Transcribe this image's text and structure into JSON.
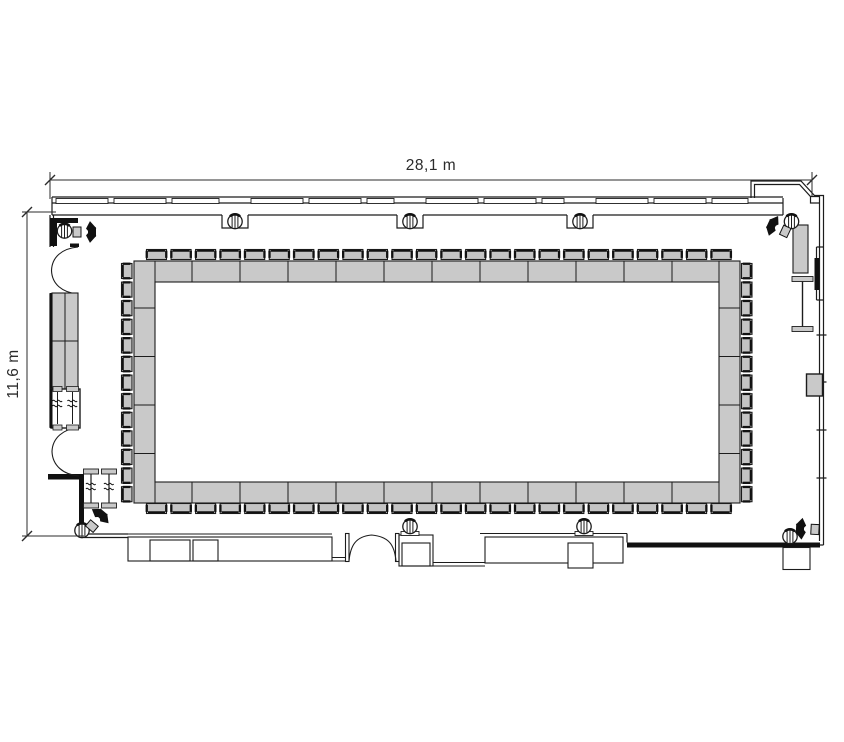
{
  "dimensions": {
    "width_label": "28,1 m",
    "height_label": "11,6 m"
  },
  "colors": {
    "background": "#ffffff",
    "line": "#1c1c1c",
    "wall_black": "#111111",
    "table_fill": "#c9c9c9",
    "chair_fill": "#c4c4c4",
    "furniture_fill": "#c9c9c9",
    "text": "#2b2b2b"
  },
  "setup": {
    "chair_counts": {
      "top": 24,
      "bottom": 24,
      "left": 13,
      "right": 13
    },
    "columns": 9,
    "speakers": 4,
    "doors": 3,
    "standing_tables": 2,
    "sideboards": 1
  }
}
